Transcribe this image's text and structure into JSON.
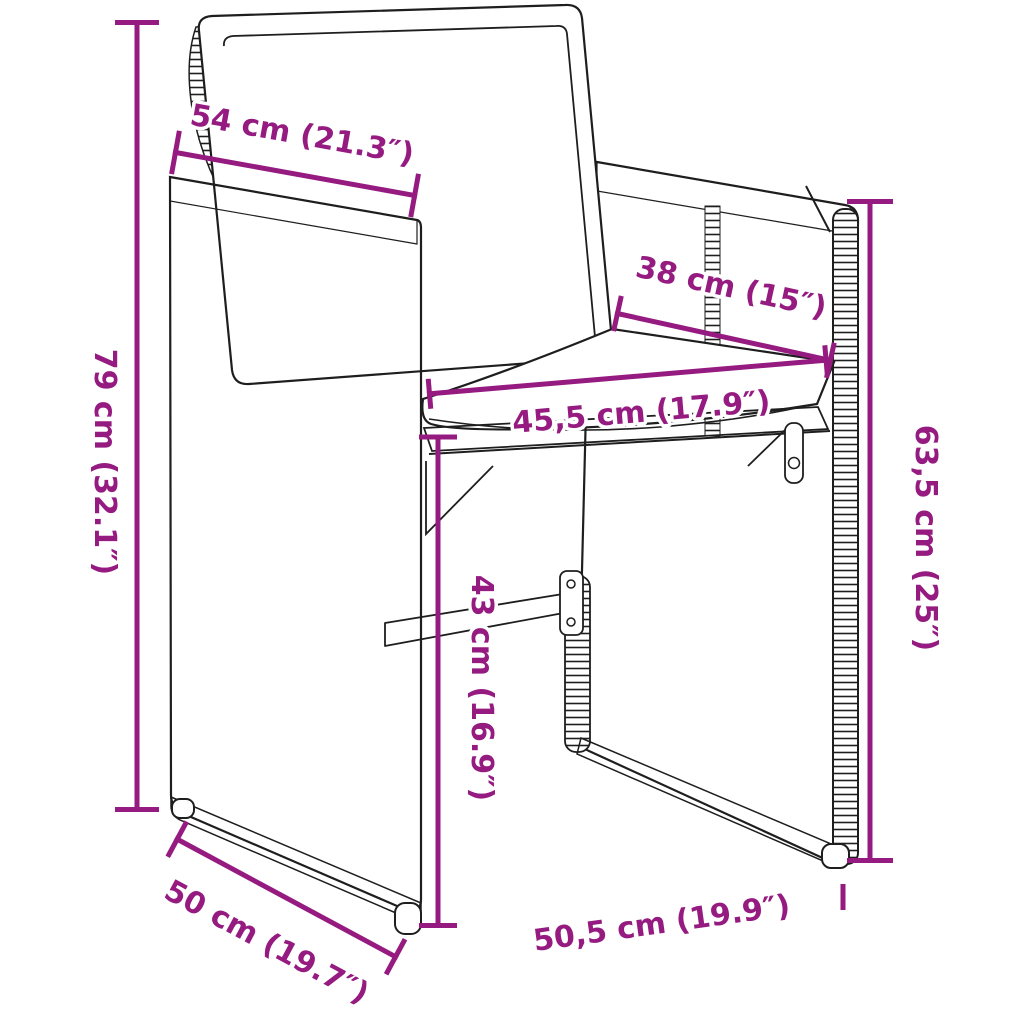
{
  "diagram": {
    "subject": "poly rattan garden chair with cushions - dimension diagram",
    "accent_color": "#951b81",
    "line_color": "#1e1e1e",
    "background_color": "#ffffff",
    "dimensions": [
      {
        "id": "top-width",
        "label": "54 cm (21.3″)"
      },
      {
        "id": "left-height",
        "label": "79 cm (32.1″)"
      },
      {
        "id": "seat-depth",
        "label": "38 cm (15″)"
      },
      {
        "id": "seat-width",
        "label": "45,5 cm (17.9″)"
      },
      {
        "id": "seat-height",
        "label": "43 cm (16.9″)"
      },
      {
        "id": "right-height",
        "label": "63,5 cm (25″)"
      },
      {
        "id": "base-depth",
        "label": "50 cm (19.7″)"
      },
      {
        "id": "base-width",
        "label": "50,5 cm (19.9″)"
      }
    ]
  }
}
